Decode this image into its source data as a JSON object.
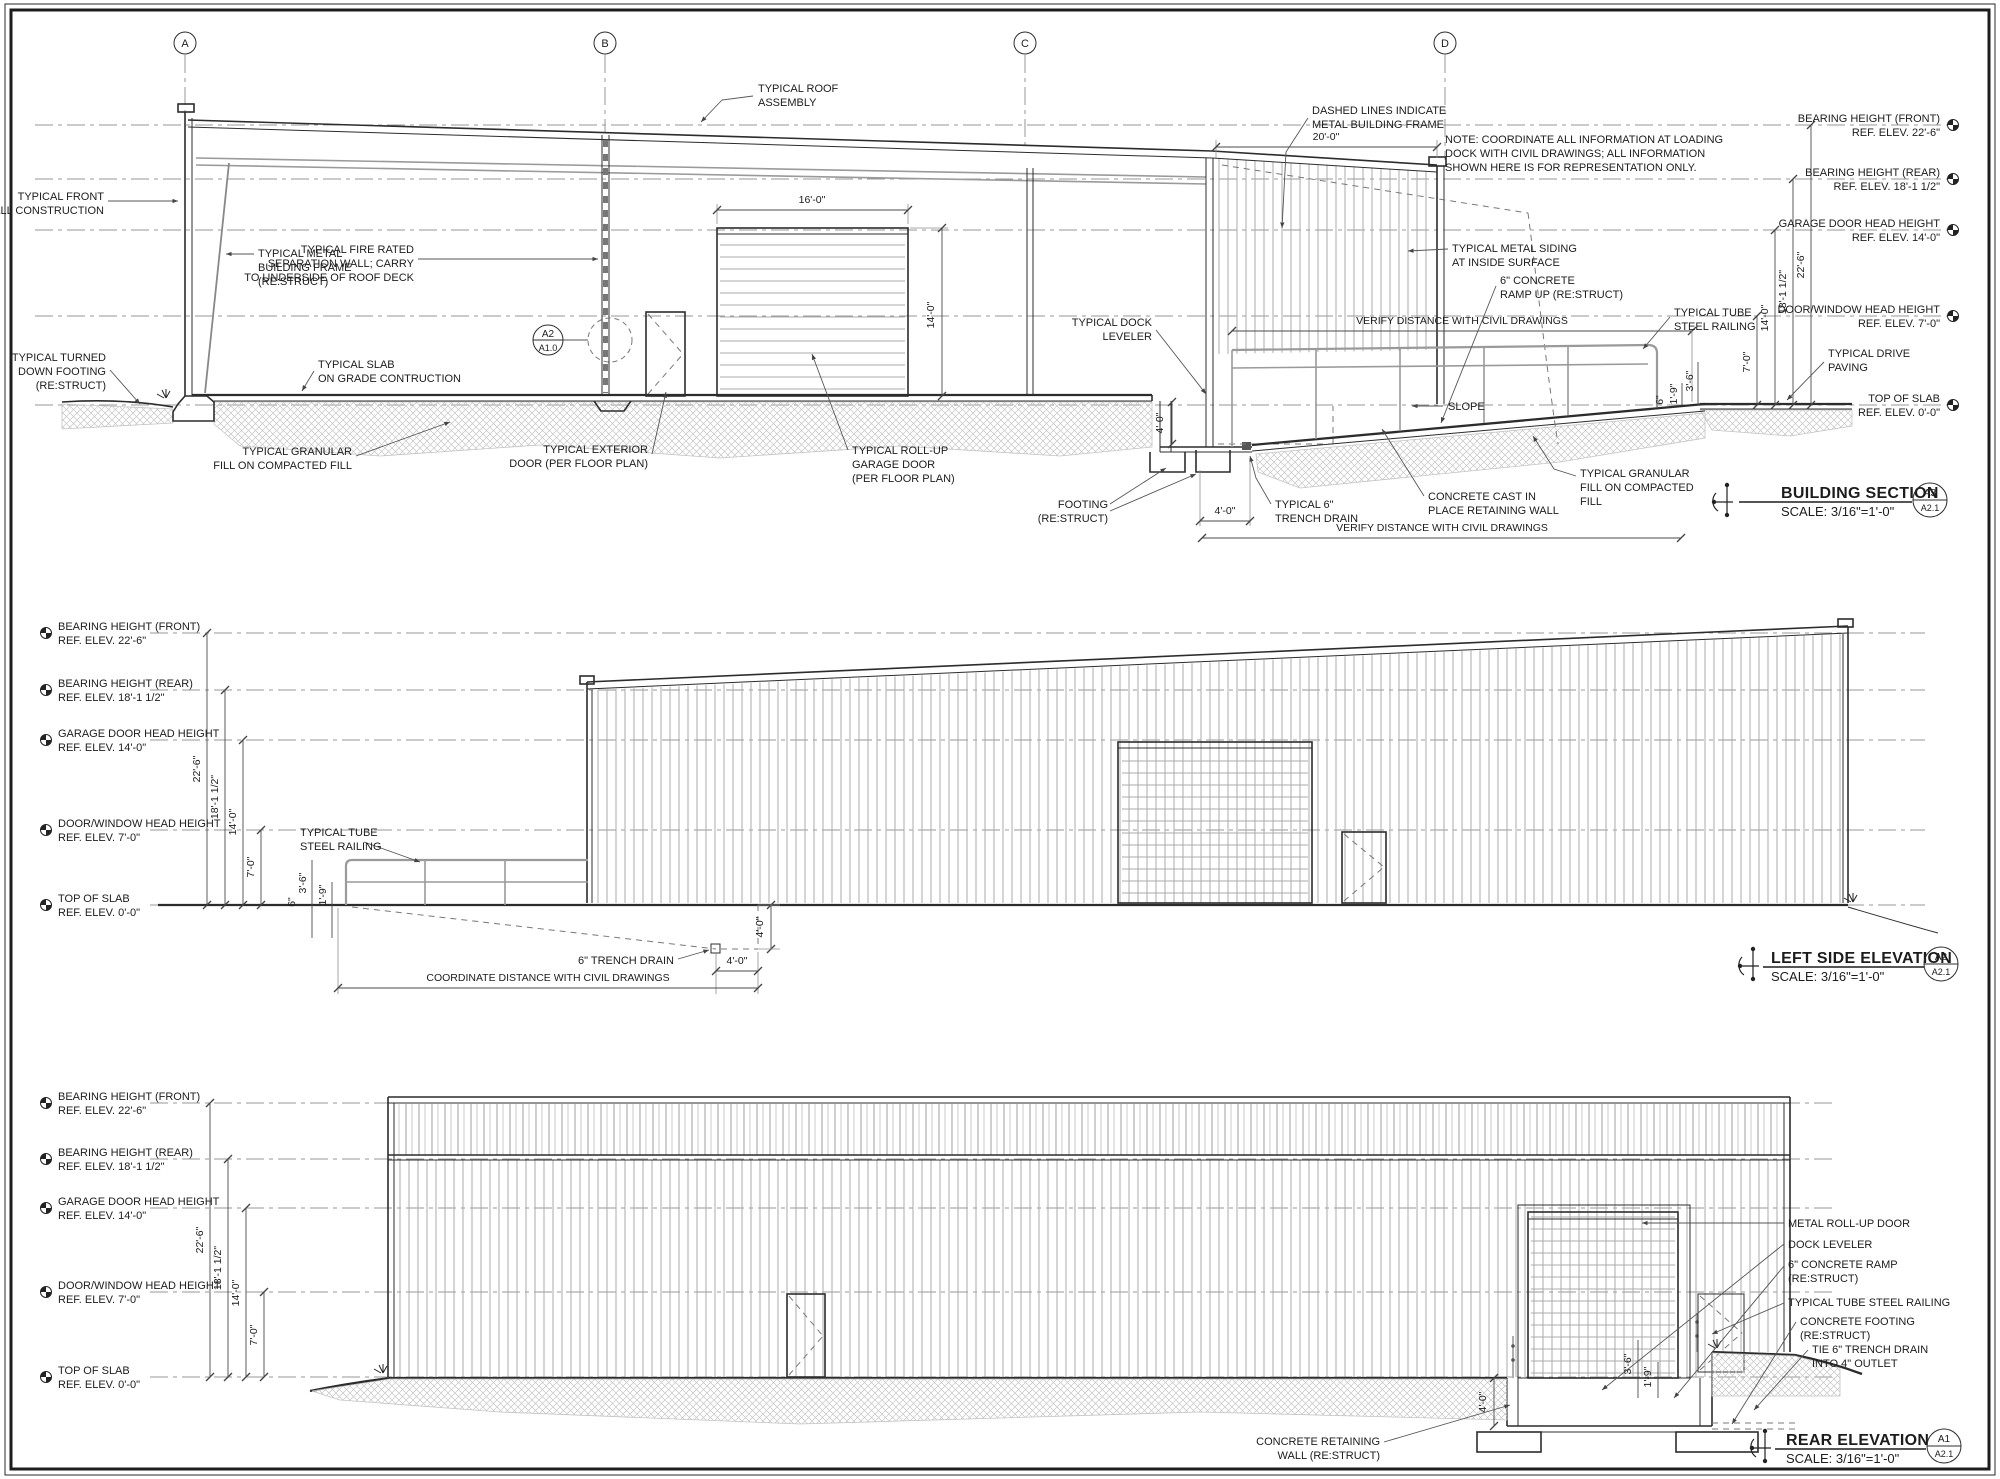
{
  "colors": {
    "ink": "#1c1c1c",
    "paper": "#ffffff",
    "light_line": "#9a9a9a"
  },
  "grid_bubbles": [
    "A",
    "B",
    "C",
    "D"
  ],
  "elev_labels": {
    "bearing_front": {
      "l1": "BEARING HEIGHT (FRONT)",
      "l2": "REF. ELEV. 22'-6\""
    },
    "bearing_rear": {
      "l1": "BEARING HEIGHT (REAR)",
      "l2": "REF. ELEV. 18'-1 1/2\""
    },
    "garage": {
      "l1": "GARAGE DOOR HEAD HEIGHT",
      "l2": "REF. ELEV. 14'-0\""
    },
    "door_window": {
      "l1": "DOOR/WINDOW HEAD HEIGHT",
      "l2": "REF. ELEV. 7'-0\""
    },
    "slab": {
      "l1": "TOP OF SLAB",
      "l2": "REF. ELEV. 0'-0\""
    }
  },
  "dims": {
    "d22": "22'-6\"",
    "d18": "18'-1 1/2\"",
    "d14": "14'-0\"",
    "d7": "7'-0\"",
    "d16": "16'-0\"",
    "d20": "20'-0\"",
    "d4": "4'-0\"",
    "d36": "3'-6\"",
    "d19": "1'-9\"",
    "d6": "6\""
  },
  "section": {
    "callouts": {
      "roof": [
        "TYPICAL ROOF",
        "ASSEMBLY"
      ],
      "front_wall": [
        "TYPICAL FRONT",
        "WALL CONSTRUCTION"
      ],
      "metal_frame": [
        "TYPICAL METAL",
        "BUILDING FRAME",
        "(RE:STRUCT)"
      ],
      "fire_wall": [
        "TYPICAL FIRE RATED",
        "SEPARATION WALL; CARRY",
        "TO UNDERSIDE OF ROOF DECK"
      ],
      "turned_footing": [
        "TYPICAL TURNED",
        "DOWN FOOTING",
        "(RE:STRUCT)"
      ],
      "slab": [
        "TYPICAL SLAB",
        "ON GRADE CONTRUCTION"
      ],
      "granular_left": [
        "TYPICAL GRANULAR",
        "FILL ON COMPACTED FILL"
      ],
      "ext_door": [
        "TYPICAL EXTERIOR",
        "DOOR (PER FLOOR PLAN)"
      ],
      "rollup": [
        "TYPICAL ROLL-UP",
        "GARAGE DOOR",
        "(PER FLOOR PLAN)"
      ],
      "dock_leveler": [
        "TYPICAL DOCK",
        "LEVELER"
      ],
      "dashed_frame": [
        "DASHED LINES INDICATE",
        "METAL BUILDING FRAME"
      ],
      "note": [
        "NOTE:  COORDINATE ALL INFORMATION AT LOADING",
        "DOCK WITH CIVIL DRAWINGS; ALL INFORMATION",
        "SHOWN HERE IS FOR REPRESENTATION ONLY."
      ],
      "siding": [
        "TYPICAL METAL SIDING",
        "AT INSIDE SURFACE"
      ],
      "ramp_up": [
        "6\" CONCRETE",
        "RAMP UP (RE:STRUCT)"
      ],
      "railing": [
        "TYPICAL TUBE",
        "STEEL RAILING"
      ],
      "verify": "VERIFY DISTANCE WITH CIVIL DRAWINGS",
      "slope": "SLOPE",
      "footing": [
        "FOOTING",
        "(RE:STRUCT)"
      ],
      "trench": [
        "TYPICAL 6\"",
        "TRENCH DRAIN"
      ],
      "retaining": [
        "CONCRETE CAST IN",
        "PLACE RETAINING WALL"
      ],
      "granular_right": [
        "TYPICAL GRANULAR",
        "FILL ON COMPACTED",
        "FILL"
      ],
      "drive": [
        "TYPICAL DRIVE",
        "PAVING"
      ]
    },
    "detail_bubble": {
      "top": "A2",
      "bottom": "A1.0"
    },
    "title": {
      "name": "BUILDING SECTION",
      "scale": "SCALE: 3/16\"=1'-0\"",
      "detail": "A3",
      "sheet": "A2.1"
    }
  },
  "left_elev": {
    "callouts": {
      "railing": [
        "TYPICAL TUBE",
        "STEEL RAILING"
      ],
      "trench": "6\" TRENCH DRAIN",
      "coordinate": "COORDINATE DISTANCE WITH CIVIL DRAWINGS"
    },
    "title": {
      "name": "LEFT SIDE ELEVATION",
      "scale": "SCALE: 3/16\"=1'-0\"",
      "detail": "A2",
      "sheet": "A2.1"
    }
  },
  "rear_elev": {
    "callouts": {
      "rollup": "METAL ROLL-UP DOOR",
      "dock_leveler": "DOCK LEVELER",
      "ramp": [
        "6\" CONCRETE RAMP",
        "(RE:STRUCT)"
      ],
      "railing": "TYPICAL TUBE STEEL RAILING",
      "footing": [
        "CONCRETE FOOTING",
        "(RE:STRUCT)"
      ],
      "tie_drain": [
        "TIE 6\" TRENCH DRAIN",
        "INTO 4\" OUTLET"
      ],
      "retaining": [
        "CONCRETE RETAINING",
        "WALL (RE:STRUCT)"
      ]
    },
    "title": {
      "name": "REAR ELEVATION",
      "scale": "SCALE: 3/16\"=1'-0\"",
      "detail": "A1",
      "sheet": "A2.1"
    }
  }
}
